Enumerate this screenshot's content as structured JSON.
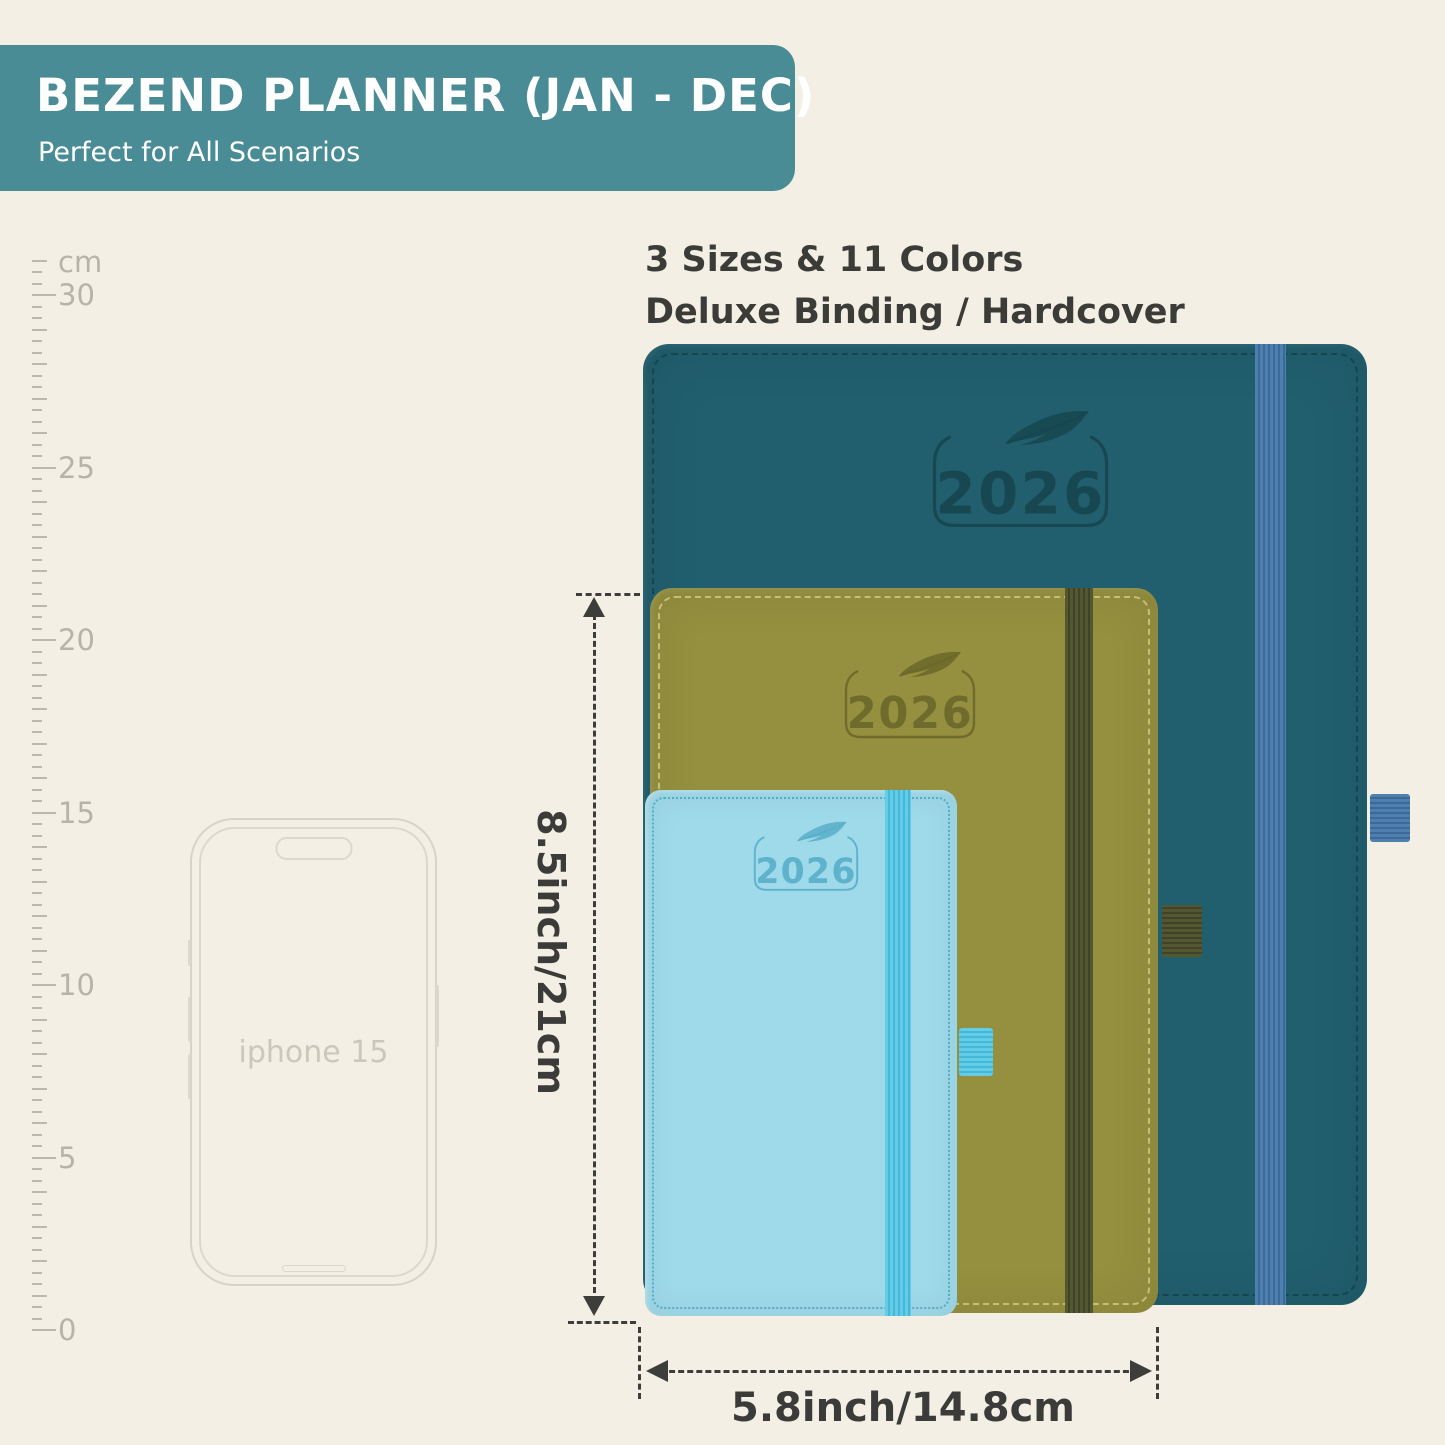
{
  "header": {
    "title": "BEZEND PLANNER (JAN - DEC)",
    "subtitle": "Perfect for All Scenarios"
  },
  "intro": {
    "line1": "3 Sizes & 11 Colors",
    "line2": "Deluxe Binding / Hardcover"
  },
  "ruler": {
    "unit_label": "cm",
    "tick_labels": [
      30,
      25,
      20,
      15,
      10,
      5,
      0
    ],
    "max_cm": 31,
    "zero_y": 1330,
    "cm_spacing_px": 34.5
  },
  "phone": {
    "label": "iphone 15"
  },
  "planners": [
    {
      "id": "large",
      "year": "2026",
      "cover_color": "#215f6e",
      "band_color": "#4a7cab"
    },
    {
      "id": "medium",
      "year": "2026",
      "cover_color": "#95903f",
      "band_color": "#4d5230"
    },
    {
      "id": "small",
      "year": "2026",
      "cover_color": "#9fdaea",
      "band_color": "#55c6e3"
    }
  ],
  "dimensions": {
    "height_label": "8.5inch/21cm",
    "width_label": "5.8inch/14.8cm"
  },
  "colors": {
    "background": "#f3efe4",
    "banner": "#4a8c95",
    "text_dark": "#3b3b38",
    "ruler": "#bcb8ae",
    "annotation": "#3d3d3b"
  }
}
